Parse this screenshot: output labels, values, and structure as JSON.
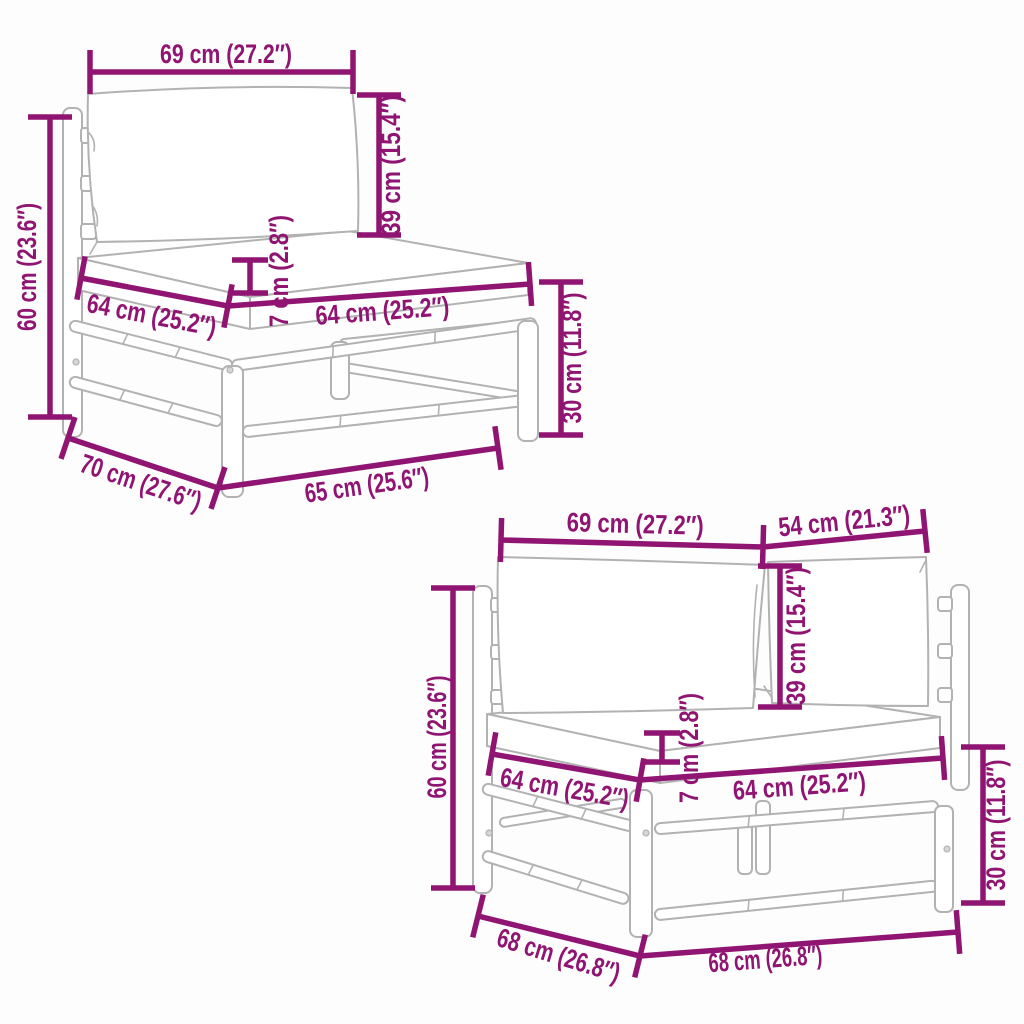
{
  "page": {
    "background": "#fdfdfd"
  },
  "diagram": {
    "colors": {
      "dimension": "#901472",
      "sketch": "#b2b2b2",
      "background": "#fdfdfd"
    },
    "sections": [
      {
        "name": "middle-sofa-section",
        "dims": {
          "back_width": "69 cm (27.2″)",
          "back_height": "39 cm (15.4″)",
          "total_height": "60 cm (23.6″)",
          "cushion_thickness": "7 cm (2.8″)",
          "seat_depth_left": "64 cm (25.2″)",
          "seat_width_right": "64 cm (25.2″)",
          "frame_height": "30 cm (11.8″)",
          "depth": "70 cm (27.6″)",
          "bottom_width": "65 cm (25.6″)"
        }
      },
      {
        "name": "corner-sofa-section",
        "dims": {
          "back_width": "69 cm (27.2″)",
          "side_back_width": "54 cm (21.3″)",
          "back_height": "39 cm (15.4″)",
          "total_height": "60 cm (23.6″)",
          "cushion_thickness": "7 cm (2.8″)",
          "seat_depth_left": "64 cm (25.2″)",
          "seat_width_right": "64 cm (25.2″)",
          "frame_height": "30 cm (11.8″)",
          "depth": "68 cm (26.8″)",
          "bottom_width": "68 cm (26.8″)"
        }
      }
    ]
  }
}
